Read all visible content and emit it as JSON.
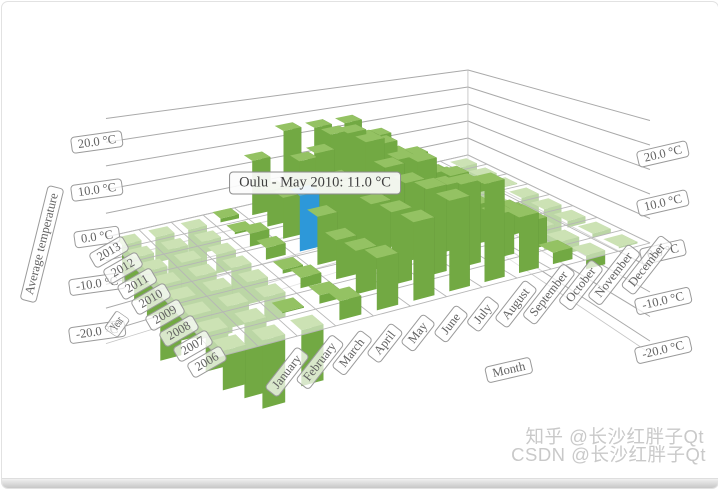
{
  "chart_data": {
    "type": "bar",
    "projection": "3d",
    "row_axis": {
      "title": "Year",
      "categories": [
        "2006",
        "2007",
        "2008",
        "2009",
        "2010",
        "2011",
        "2012",
        "2013"
      ]
    },
    "column_axis": {
      "title": "Month",
      "categories": [
        "January",
        "February",
        "March",
        "April",
        "May",
        "June",
        "July",
        "August",
        "September",
        "October",
        "November",
        "December"
      ]
    },
    "value_axis": {
      "title": "Average temperature",
      "unit": "°C",
      "tick_labels": [
        "20.0 °C",
        "10.0 °C",
        "0.0 °C",
        "-10.0 °C",
        "-20.0 °C"
      ],
      "tick_values": [
        20,
        10,
        0,
        -10,
        -20
      ],
      "gridline_step": 5,
      "range": [
        -22.5,
        25
      ]
    },
    "series": [
      {
        "name": "2006",
        "values": [
          -6.7,
          -11.7,
          -9.7,
          3.3,
          9.2,
          14.0,
          16.3,
          17.8,
          10.2,
          2.1,
          -2.6,
          -0.3
        ]
      },
      {
        "name": "2007",
        "values": [
          -6.8,
          -13.3,
          0.2,
          1.5,
          7.9,
          13.4,
          16.1,
          15.5,
          8.2,
          5.4,
          -2.6,
          -0.8
        ]
      },
      {
        "name": "2008",
        "values": [
          -4.2,
          -4.0,
          -4.6,
          1.9,
          7.3,
          12.5,
          15.0,
          12.8,
          7.6,
          5.1,
          -0.9,
          -1.3
        ]
      },
      {
        "name": "2009",
        "values": [
          -7.8,
          -8.8,
          -4.2,
          0.7,
          9.3,
          13.2,
          15.8,
          15.5,
          11.2,
          0.6,
          0.7,
          -8.4
        ]
      },
      {
        "name": "2010",
        "values": [
          -14.4,
          -12.1,
          -7.0,
          2.3,
          11.0,
          12.6,
          18.8,
          13.8,
          9.4,
          3.9,
          -5.6,
          -13.0
        ]
      },
      {
        "name": "2011",
        "values": [
          -9.0,
          -15.2,
          -3.8,
          2.6,
          8.3,
          15.9,
          18.6,
          14.9,
          11.1,
          5.3,
          1.8,
          -0.2
        ]
      },
      {
        "name": "2012",
        "values": [
          -8.7,
          -11.3,
          -2.3,
          0.4,
          7.5,
          12.2,
          16.4,
          14.1,
          9.2,
          3.1,
          0.3,
          -12.1
        ]
      },
      {
        "name": "2013",
        "values": [
          -7.9,
          -5.3,
          -9.1,
          0.8,
          11.6,
          16.6,
          15.9,
          15.5,
          11.2,
          4.0,
          0.1,
          -3.1
        ]
      }
    ],
    "selection": {
      "series": "2010",
      "category": "May",
      "value": 11.0
    },
    "colors": {
      "bar_front": "#72a943",
      "bar_side": "#4d7a28",
      "bar_top": "#94c263",
      "selected_front": "#2d98d9",
      "selected_side": "#1e6fa7",
      "selected_top": "#55aee1",
      "grid_line": "#b6b6b6",
      "wall_line": "#a9a9a9",
      "label_border": "#9a9a9a",
      "label_text": "#626262"
    }
  },
  "tooltip": {
    "text": "Oulu - May 2010: 11.0 °C"
  },
  "watermark": {
    "line1": "知乎 @长沙红胖子Qt",
    "line2": "CSDN @长沙红胖子Qt"
  }
}
